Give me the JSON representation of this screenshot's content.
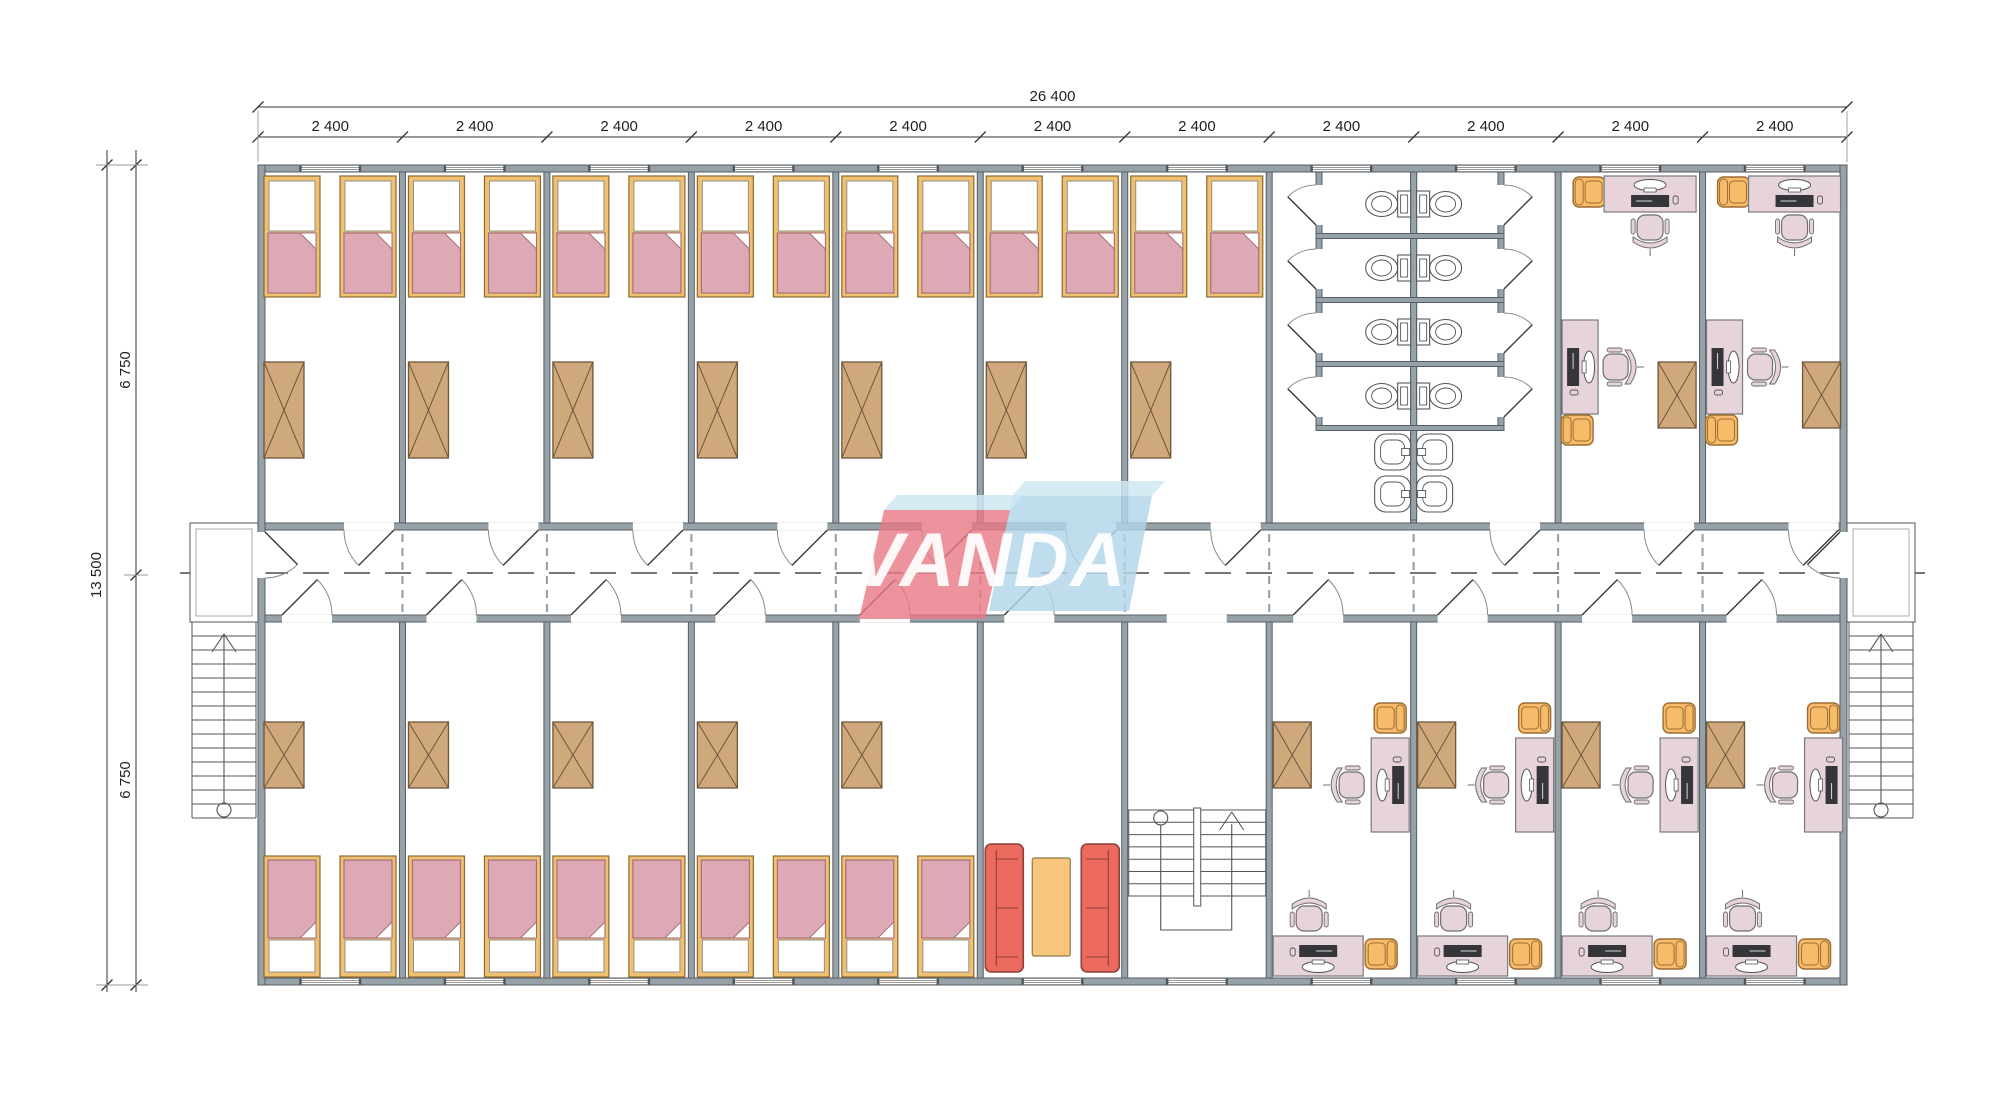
{
  "drawing": {
    "top_dimension_total": "26 400",
    "top_dimension_segments": [
      "2 400",
      "2 400",
      "2 400",
      "2 400",
      "2 400",
      "2 400",
      "2 400",
      "2 400",
      "2 400",
      "2 400",
      "2 400"
    ],
    "left_dimension_total": "13 500",
    "left_dimension_segments": [
      "6 750",
      "6 750"
    ]
  },
  "logo": {
    "text": "VANDA",
    "red": "rgba(232,120,132,0.80)",
    "blue": "rgba(178,213,233,0.82)",
    "light": "rgba(208,231,243,0.85)",
    "text_color": "rgba(255,255,255,0.93)"
  },
  "palette": {
    "wall": "#97A1A8",
    "wall_edge": "#545E66",
    "line": "#4C4C4C",
    "dim_text": "#1F1F1F",
    "bed_frame": "#F2C170",
    "bed_frame_edge": "#8A6A33",
    "blanket": "#DCA9B4",
    "blanket_edge": "#A4707E",
    "wardrobe": "#CFA97C",
    "wardrobe_edge": "#6F5638",
    "desk": "#E6D4DA",
    "desk_edge": "#7A7A7A",
    "device": "#35353A",
    "chair_orange": "#F6BC6A",
    "chair_orange_edge": "#9C6D33",
    "sofa": "#ED6A5F",
    "sofa_edge": "#8C4038",
    "table": "#F8C57C",
    "table_edge": "#8A7A45",
    "fixture_edge": "#565656"
  },
  "plan": {
    "top_rooms": [
      "bedroom",
      "bedroom",
      "bedroom",
      "bedroom",
      "bedroom",
      "bedroom",
      "bedroom",
      "toilets",
      "toilets",
      "office",
      "office"
    ],
    "bottom_rooms": [
      "bedroom",
      "bedroom",
      "bedroom",
      "bedroom",
      "bedroom",
      "lounge",
      "stairwell",
      "office",
      "office",
      "office",
      "office"
    ],
    "module_count": 11
  }
}
